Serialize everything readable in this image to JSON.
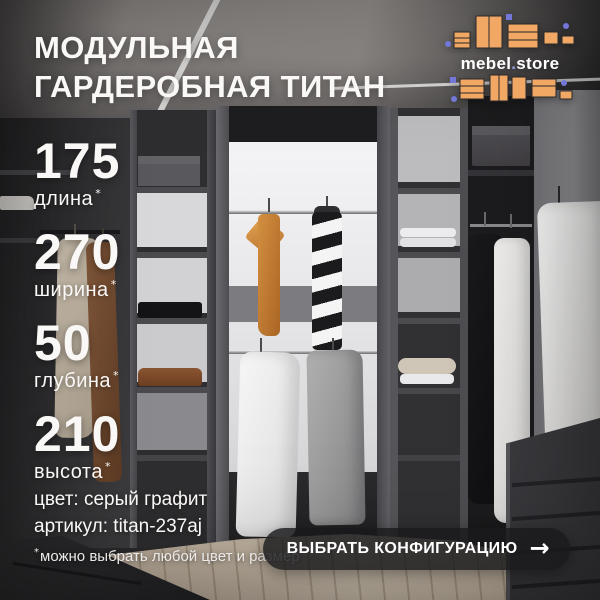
{
  "title": {
    "line1": "МОДУЛЬНАЯ",
    "line2": "ГАРДЕРОБНАЯ ТИТАН"
  },
  "logo": {
    "brand_left": "mebel",
    "dot": ".",
    "brand_right": "store"
  },
  "specs": {
    "items": [
      {
        "value": "175",
        "label": "длина",
        "marker": "*"
      },
      {
        "value": "270",
        "label": "ширина",
        "marker": "*"
      },
      {
        "value": "50",
        "label": "глубина",
        "marker": "*"
      },
      {
        "value": "210",
        "label": "высота",
        "marker": "*"
      }
    ]
  },
  "details": {
    "color_line": "цвет: серый графит",
    "sku_line": "артикул: titan-237aj"
  },
  "footnote": {
    "marker": "*",
    "text": "можно выбрать любой цвет и размер"
  },
  "cta": {
    "label": "ВЫБРАТЬ КОНФИГУРАЦИЮ",
    "arrow": "→"
  },
  "colors": {
    "accent_orange": "#F0A864",
    "accent_purple": "#7277D8",
    "graphite": "#2F2E30",
    "white_panel": "#ECECEE",
    "cta_bg": "rgba(26,26,28,0.82)",
    "text": "#FAF8F6"
  }
}
